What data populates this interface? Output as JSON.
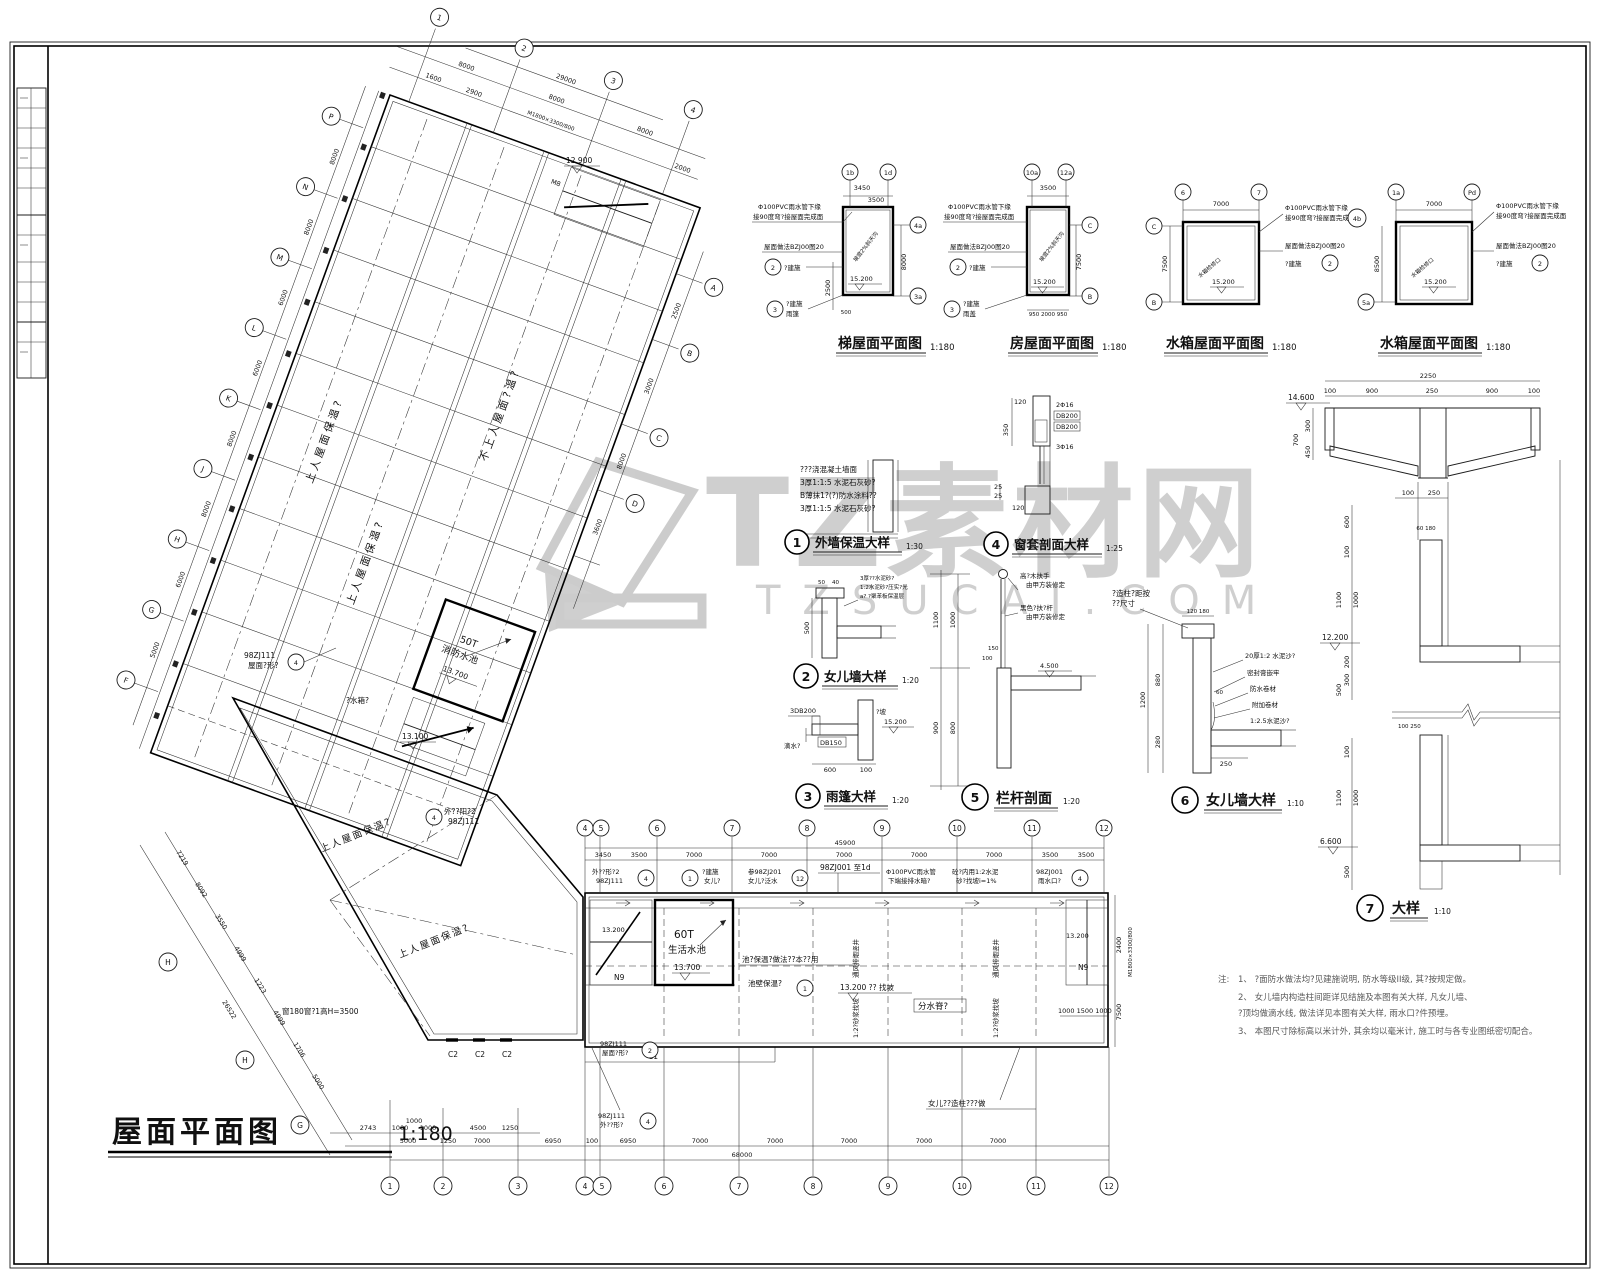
{
  "watermark": {
    "title": "TZ素材网",
    "subtitle": "TZSUCAI.COM"
  },
  "main_plan": {
    "title": "屋面平面图",
    "scale": "1:180",
    "pool": {
      "cap": "50T",
      "name": "消防水池",
      "level": "13.700"
    },
    "levels": {
      "stair_top": "12.900",
      "stair_mid": "13.100"
    },
    "door_spec": "M1800×3300/800",
    "stair_mark": "M8",
    "areas": [
      "上人屋面保温?",
      "上人屋面保温?",
      "不上人屋面?温?",
      "上人屋面保温?",
      "上人屋面保温?"
    ],
    "water_note": "?水箱?",
    "window_note": "窗180窗?1高H=3500",
    "callout_roof": {
      "a": "98ZJ111",
      "b": "屋面?形?"
    },
    "callout_balc": {
      "a": "外??阳?2",
      "b": "98ZJ111"
    },
    "grid_top": [
      "1",
      "2",
      "3",
      "4"
    ],
    "grid_left": [
      "P",
      "N",
      "M",
      "L",
      "K",
      "J",
      "H",
      "G",
      "F"
    ],
    "grid_right": [
      "A",
      "B",
      "C",
      "D"
    ],
    "grid_pent": [
      "H",
      "H",
      "G"
    ],
    "dims_top1": [
      "1600",
      "2900",
      "2000"
    ],
    "dims_top2": [
      "8000",
      "8000",
      "8000"
    ],
    "dims_top_total": "29000",
    "dims_left": [
      "8000",
      "8000",
      "6000",
      "6000",
      "8000",
      "8000",
      "6000",
      "5000"
    ],
    "dims_right": [
      "2500",
      "3000",
      "8000",
      "3600"
    ],
    "dims_pent": [
      "7219",
      "8092",
      "3550",
      "4999",
      "1223",
      "4999",
      "1706",
      "5000"
    ],
    "dims_pent_total": "26522"
  },
  "wing": {
    "grid_top": [
      "4",
      "5",
      "6",
      "7",
      "8",
      "9",
      "10",
      "11",
      "12"
    ],
    "grid_bottom": [
      "1",
      "2",
      "3",
      "4",
      "5",
      "6",
      "7",
      "8",
      "9",
      "10",
      "11",
      "12"
    ],
    "dims_top": [
      "3450",
      "3500",
      "7000",
      "7000",
      "7000",
      "7000",
      "7000",
      "3500",
      "3500"
    ],
    "dims_top_total": "45900",
    "dims_b1": [
      "2743",
      "1000",
      "1000",
      "1000",
      "4500",
      "1250"
    ],
    "dims_b2": [
      "5000",
      "1250",
      "7000",
      "6950",
      "100",
      "6950",
      "7000",
      "7000",
      "7000",
      "7000",
      "7000"
    ],
    "dims_b_total": "68000",
    "dims_right": [
      "2400",
      "7500"
    ],
    "door_spec": "M1800×3300/800",
    "stair_dims": "1000 1500 1000",
    "tank": {
      "cap": "60T",
      "name": "生活水池",
      "level": "13.700"
    },
    "stairs": {
      "left_level": "13.200",
      "left_mark": "N9",
      "right_level": "13.200",
      "right_mark": "N9"
    },
    "mid_level": "13.200 ?? 找坡",
    "ridge": "分水脊?",
    "parapet_note": "女儿??造柱???做",
    "pool_note1": "池?保温?做法??本??用",
    "pool_note2": "池壁保温?",
    "shaft": "通风排烟竖井",
    "slope": "1:2?砂浆找坡",
    "win": [
      "C2",
      "C2",
      "C2",
      "C1"
    ],
    "co1": {
      "a": "外??形?2",
      "b": "98ZJ111"
    },
    "co2": {
      "a": "?建施",
      "b": "女儿?"
    },
    "co3": {
      "a": "参98ZJ201",
      "b": "女儿?泛水"
    },
    "co4": "98ZJ001 至1d",
    "co5": {
      "a": "Φ100PVC雨水管",
      "b": "下端接排水暗?"
    },
    "co6": {
      "a": "砼?内用1:2水泥",
      "b": "砂?找坡i=1%"
    },
    "co7": {
      "a": "98ZJ001",
      "b": "雨水口?"
    },
    "co8": {
      "a": "98ZJ111",
      "b": "屋面?形?"
    },
    "co9": {
      "a": "98ZJ111",
      "b": "外??形?"
    }
  },
  "plans": [
    {
      "title": "梯屋面平面图",
      "scale": "1:180",
      "level": "15.200",
      "b1": "1b",
      "b2": "1d",
      "b3": "4a",
      "b4": "3a",
      "d1": "3450",
      "d2": "3500",
      "d3": "8000",
      "d4": "2500",
      "d5": "500",
      "ld1": "Φ100PVC雨水管下缘",
      "ld2": "接90度弯?接屋面完成面",
      "ld3": "屋面做法BZJ00图20",
      "ld4": "?建施",
      "ld5": "?建施",
      "ld6": "雨篷",
      "slope": "坡度2%斜天沟"
    },
    {
      "title": "房屋面平面图",
      "scale": "1:180",
      "level": "15.200",
      "b1": "10a",
      "b2": "12a",
      "b3": "C",
      "b4": "B",
      "d1": "3500",
      "d2": "950 2000 950",
      "d3": "7500",
      "ld1": "Φ100PVC雨水管下缘",
      "ld2": "接90度弯?接屋面完成面",
      "ld3": "屋面做法BZJ00图20",
      "ld4": "?建施",
      "ld5": "?建施",
      "ld6": "雨盖",
      "slope": "坡度2%斜天沟"
    },
    {
      "title": "水箱屋面平面图",
      "scale": "1:180",
      "level": "15.200",
      "b1": "6",
      "b2": "7",
      "b3": "C",
      "b4": "B",
      "b5": "4b",
      "d1": "7000",
      "d3": "7500",
      "ld1": "Φ100PVC雨水管下缘",
      "ld2": "接90度弯?接屋面完成面",
      "ld3": "屋面做法BZJ00图20",
      "ld4": "?建施",
      "slope": "水箱检修口"
    },
    {
      "title": "水箱屋面平面图",
      "scale": "1:180",
      "level": "15.200",
      "b1": "1a",
      "b2": "Pd",
      "b3": "5a",
      "d1": "7000",
      "d3": "8500",
      "ld1": "Φ100PVC雨水管下缘",
      "ld2": "接90度弯?接屋面完成面",
      "ld3": "屋面做法BZJ00图20",
      "ld4": "?建施",
      "slope": "水箱检修口"
    }
  ],
  "details": [
    {
      "no": "1",
      "title": "外墙保温大样",
      "scale": "1:30",
      "t1": "???浇混凝土墙面",
      "t2": "3厚1:1:5 水泥石灰砂?",
      "t3": "B薄抹1?(?)防水涂料??",
      "t4": "3厚1:1:5 水泥石灰砂?"
    },
    {
      "no": "2",
      "title": "女儿墙大样",
      "scale": "1:20",
      "t1": "3厚??水泥砂?",
      "t2": "1:2水泥砂?压实?光",
      "t3": "a? ?聚苯板保温层",
      "d1": "500",
      "d2": "50",
      "d3": "40"
    },
    {
      "no": "3",
      "title": "雨篷大样",
      "scale": "1:20",
      "t1": "3DB200",
      "t2": "DB150",
      "t3": "滴水?",
      "t4": "?坡",
      "level": "15.200",
      "d1": "600",
      "d2": "100"
    },
    {
      "no": "4",
      "title": "窗套剖面大样",
      "scale": "1:25",
      "t1": "2Φ16",
      "t2": "DB200",
      "t3": "DB200",
      "t4": "3Φ16",
      "d1": "120",
      "d2": "350",
      "d3": "25",
      "d4": "25",
      "d5": "120"
    },
    {
      "no": "5",
      "title": "栏杆剖面",
      "scale": "1:20",
      "t1": "高?木扶手",
      "t2": "由甲方装修定",
      "t3": "黑色?扶?杆",
      "t4": "由甲方装修定",
      "level": "4.500",
      "d1": "1100",
      "d2": "1000",
      "d3": "900",
      "d4": "800",
      "d5": "150",
      "d6": "100"
    },
    {
      "no": "6",
      "title": "女儿墙大样",
      "scale": "1:10",
      "t1": "?造柱?距按",
      "t2": "??尺寸",
      "t3": "20厚1:2 水泥沙?",
      "t4": "密封膏嵌牢",
      "t5": "防水卷材",
      "t6": "附加卷材",
      "t7": "1:2.5水泥沙?",
      "d1": "120 180",
      "d2": "1200",
      "d3": "880",
      "d4": "280",
      "d5": "60",
      "d6": "250",
      "level": "12.200"
    },
    {
      "no": "7",
      "title": "大样",
      "scale": "1:10",
      "d_total": "2250",
      "da": "100",
      "db": "900",
      "dc": "250",
      "dd": "900",
      "de": "100",
      "level_top": "14.600",
      "d300": "300",
      "d450": "450",
      "d700": "700",
      "d600": "600",
      "d100": "100",
      "d1100": "1100",
      "d1000": "1000",
      "level_mid": "12.200",
      "d200": "200",
      "d300b": "300",
      "d500": "500",
      "d60": "60 180",
      "d250": "100 250",
      "level_low": "6.600"
    }
  ],
  "notes": {
    "head": "注:",
    "n1": "1、 ?面防水做法均?见建施说明, 防水等级II级, 其?按规定做。",
    "n2": "2、 女儿墙内构造柱间距详见结施及本图有关大样, 凡女儿墙、",
    "n2b": "      ?顶均做滴水线, 做法详见本图有关大样, 雨水口?件预埋。",
    "n3": "3、 本图尺寸除标高以米计外, 其余均以毫米计, 施工时与各专业图纸密切配合。"
  }
}
